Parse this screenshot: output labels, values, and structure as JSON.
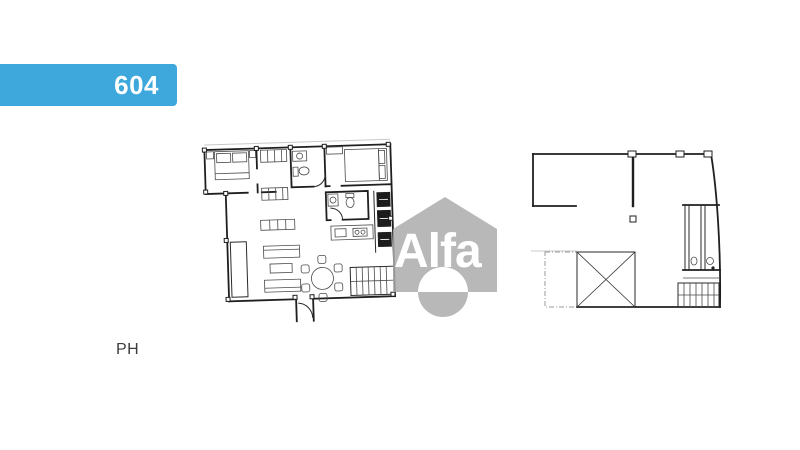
{
  "canvas": {
    "width": 800,
    "height": 450,
    "background": "#ffffff"
  },
  "unit_banner": {
    "label": "604",
    "background_color": "#3ea8dd",
    "text_color": "#ffffff"
  },
  "floor_label": {
    "text": "PH",
    "color": "#3c3c3c"
  },
  "watermark": {
    "brand": "Alfa",
    "icon": "house-icon",
    "house_color": "#acacac",
    "text_color_inside": "#ffffff",
    "text_color_outside": "#d9d9d9"
  }
}
